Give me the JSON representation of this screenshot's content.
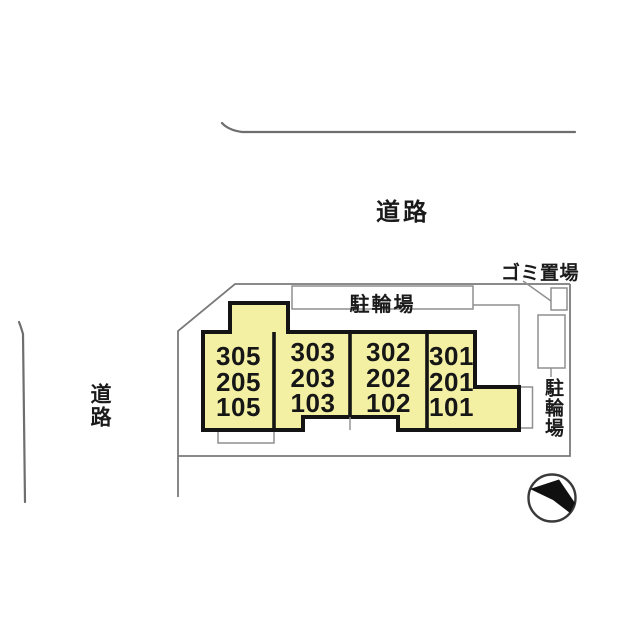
{
  "page": {
    "type": "site-plan"
  },
  "labels": {
    "road_top": "道路",
    "road_left": "道路",
    "garbage_area": "ゴミ置場",
    "bicycle_parking_top": "駐輪場",
    "bicycle_parking_right": "駐輪場"
  },
  "building": {
    "columns": [
      {
        "units": [
          "305",
          "205",
          "105"
        ]
      },
      {
        "units": [
          "303",
          "203",
          "103"
        ]
      },
      {
        "units": [
          "302",
          "202",
          "102"
        ]
      },
      {
        "units": [
          "301",
          "201",
          "101"
        ]
      }
    ]
  },
  "icons": {
    "north_arrow": "north-arrow"
  },
  "colors": {
    "building_fill": "#F3F0A4",
    "building_outline": "#141414",
    "boundary_line": "#7A7A7A",
    "road_line": "#6E6E6E",
    "text": "#1A1A1A",
    "background": "#FFFFFF"
  }
}
